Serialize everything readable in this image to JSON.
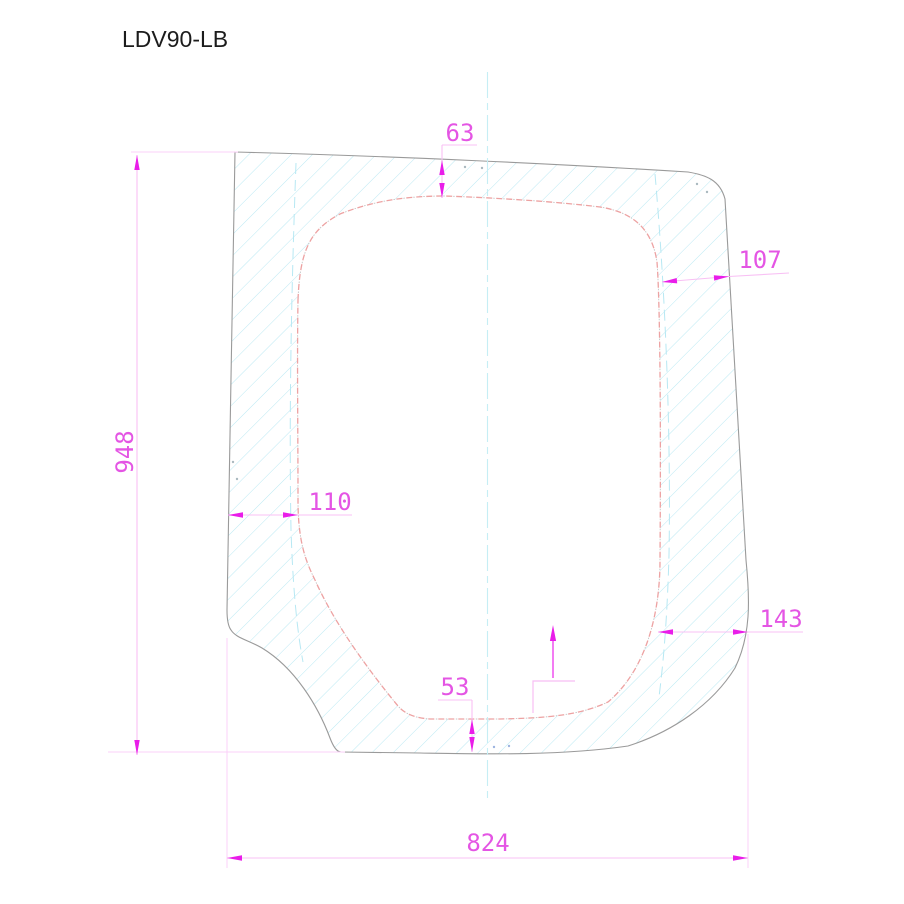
{
  "title": "LDV90-LB",
  "drawing_type": "glass-panel-technical-drawing",
  "dimensions": {
    "overall_height": "948",
    "overall_width": "824",
    "top_band": "63",
    "right_upper_band": "107",
    "left_band": "110",
    "right_lower_band": "143",
    "bottom_band": "53"
  },
  "marks": {
    "orientation_arrow": "up"
  },
  "colors": {
    "dimension_text_magenta": "#e455e4",
    "dimension_arrow_magenta": "#e91de9",
    "dimension_line_pink": "#f8c0f4",
    "outline_gray": "#9a9a9a",
    "hatch_cyan": "#b3e7f2",
    "inner_edge_salmon": "#eda2a2",
    "centerline_cyan": "#c6eef5",
    "title_black": "#1c1c1c",
    "background": "#ffffff"
  }
}
